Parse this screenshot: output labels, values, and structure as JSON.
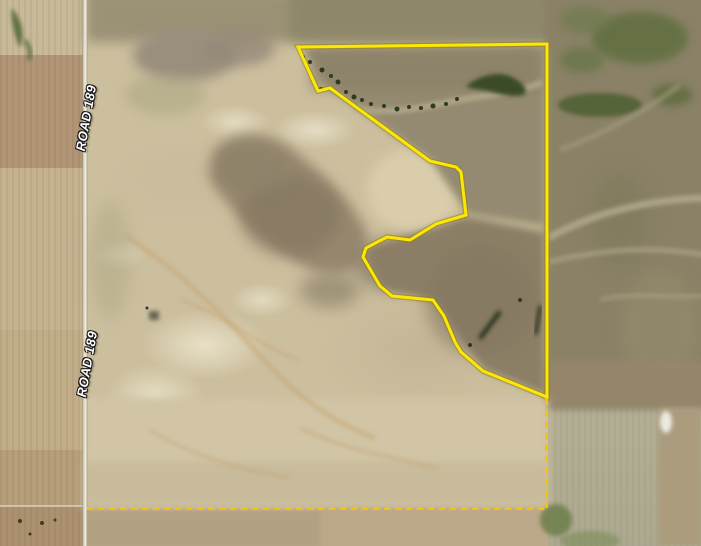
{
  "map": {
    "type": "satellite-parcel-map",
    "road": {
      "name": "ROAD 189",
      "labels": [
        {
          "text": "ROAD 189",
          "x": 86,
          "y": 118,
          "rotation_deg": -80
        },
        {
          "text": "ROAD 189",
          "x": 87,
          "y": 364,
          "rotation_deg": -80
        }
      ]
    },
    "parcel_boundary": {
      "style": "solid",
      "color": "#fce803",
      "outline_color": "#8f7d00",
      "points": [
        [
          298,
          47
        ],
        [
          547,
          44
        ],
        [
          547,
          397
        ],
        [
          483,
          371
        ],
        [
          461,
          352
        ],
        [
          455,
          342
        ],
        [
          444,
          316
        ],
        [
          433,
          300
        ],
        [
          392,
          296
        ],
        [
          380,
          286
        ],
        [
          363,
          257
        ],
        [
          366,
          248
        ],
        [
          387,
          237
        ],
        [
          410,
          240
        ],
        [
          436,
          224
        ],
        [
          466,
          215
        ],
        [
          461,
          172
        ],
        [
          456,
          167
        ],
        [
          430,
          161
        ],
        [
          330,
          88
        ],
        [
          318,
          91
        ]
      ]
    },
    "section_lines": {
      "style": "dashed",
      "color": "#f3c20f",
      "segments": [
        {
          "id": "vertical",
          "x1": 546.5,
          "y1": 398,
          "x2": 546.5,
          "y2": 508
        },
        {
          "id": "horizontal",
          "x1": 87,
          "y1": 508.5,
          "x2": 546.5,
          "y2": 508.5
        }
      ]
    }
  }
}
